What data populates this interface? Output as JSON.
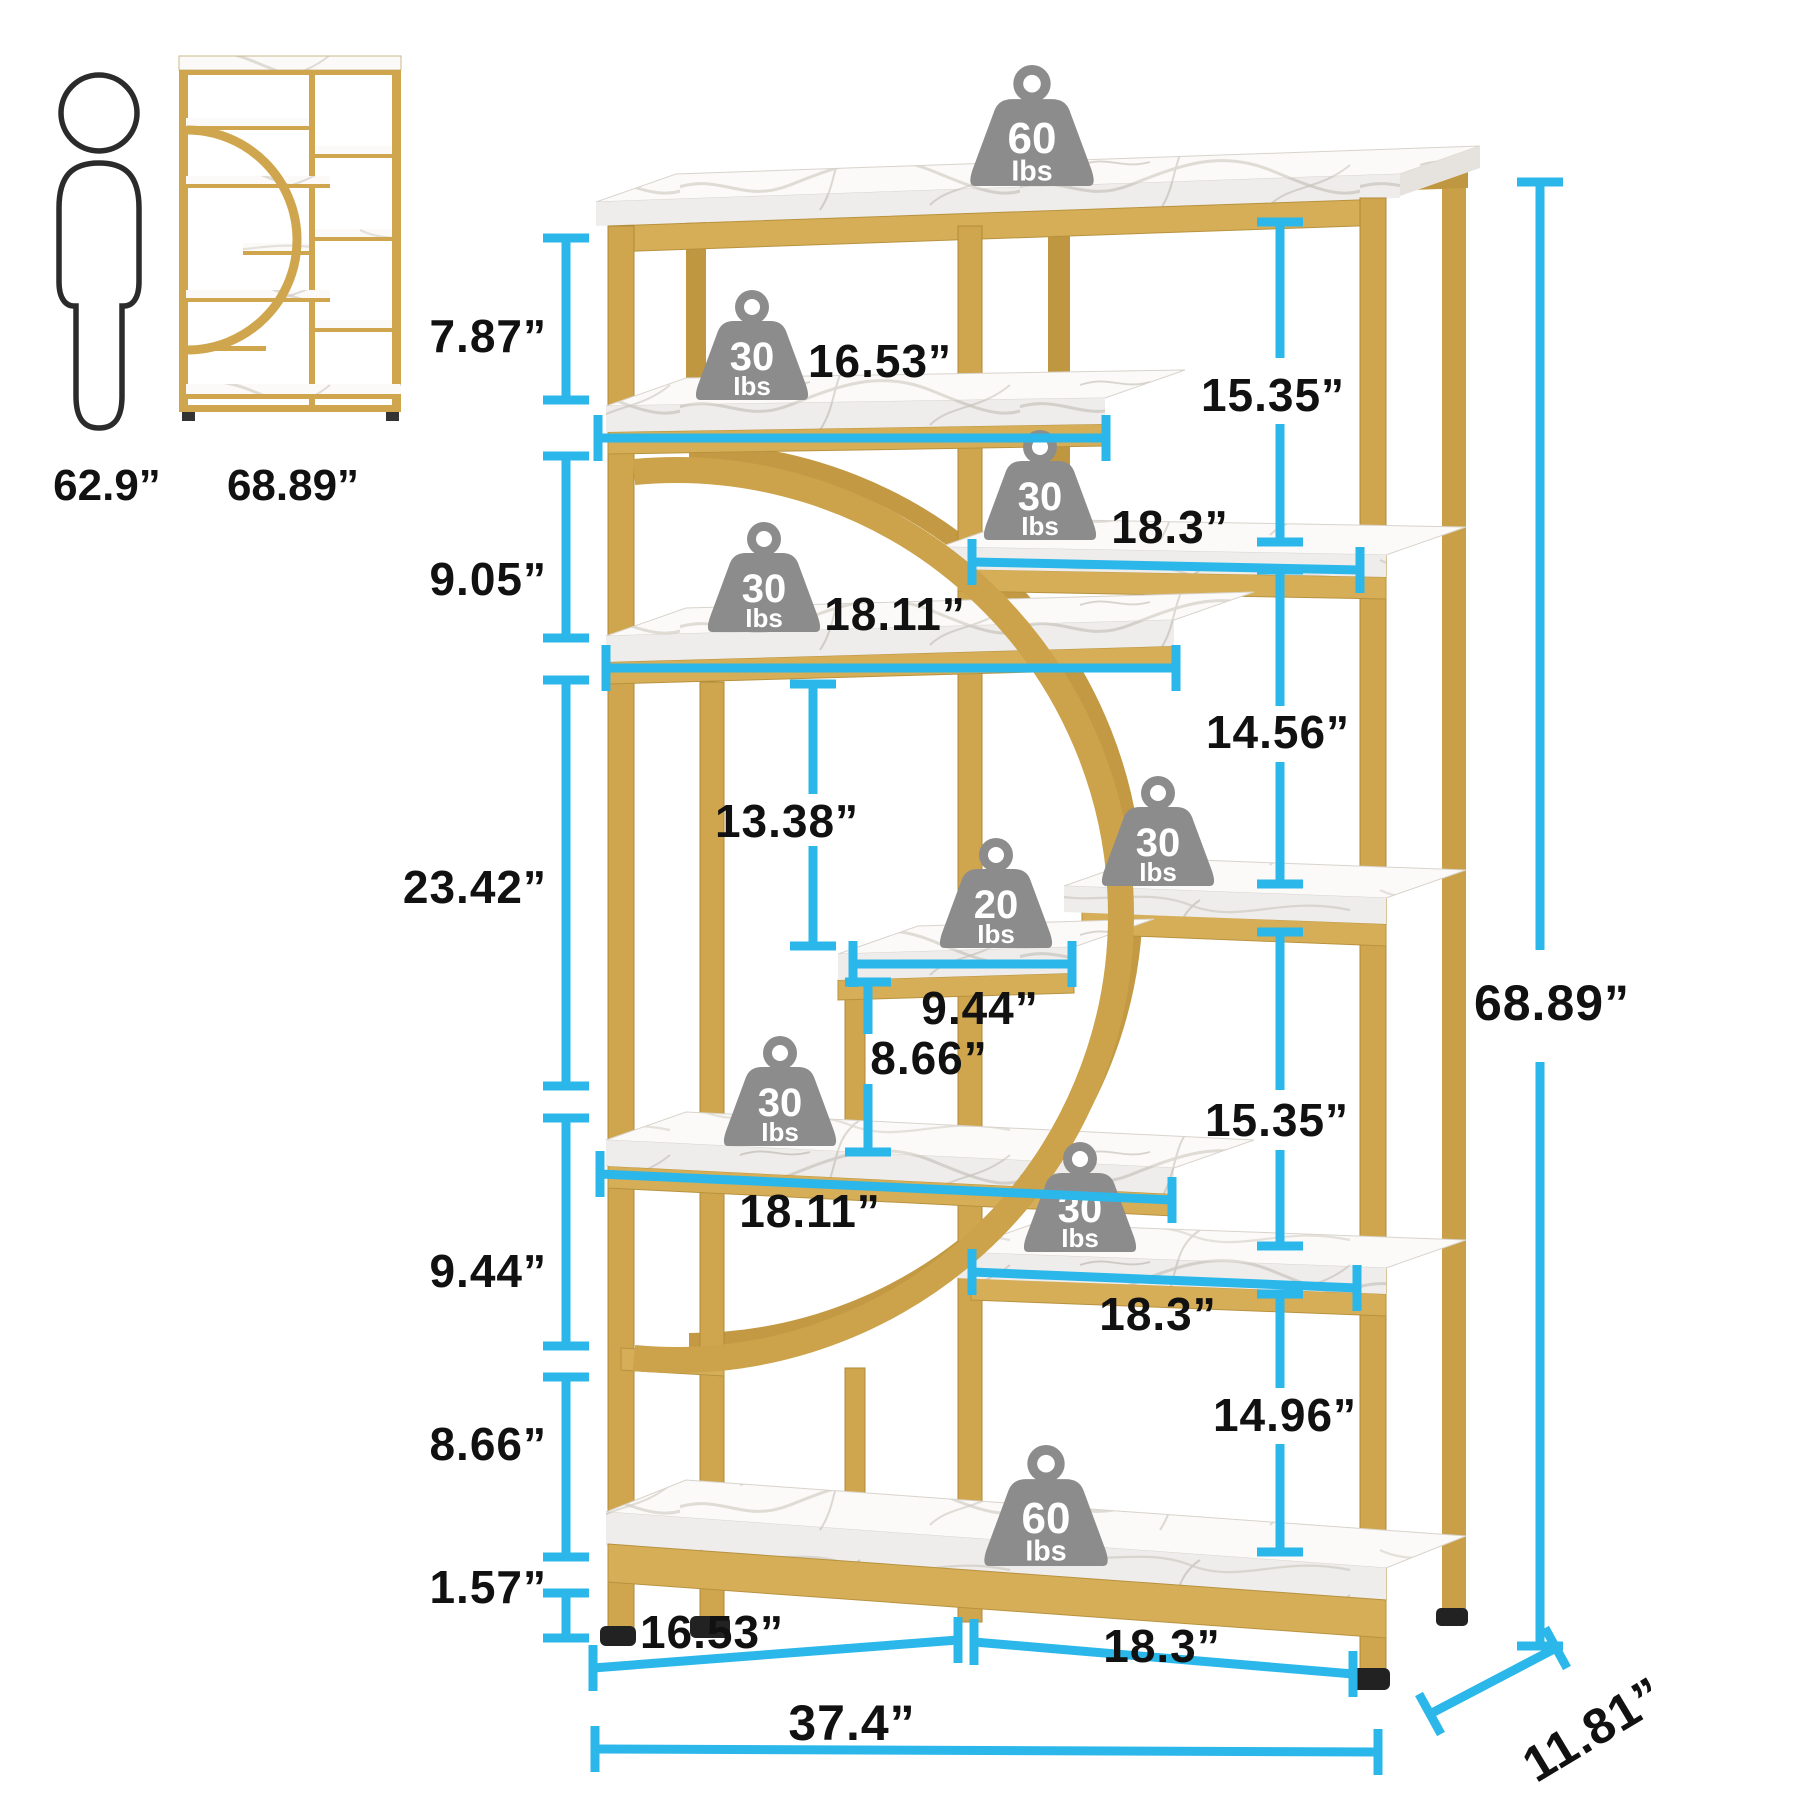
{
  "title": "Etagere bookshelf dimension diagram",
  "colors": {
    "gold": "#CFA64E",
    "gold_light": "#D9B262",
    "gold_dark": "#C09741",
    "marble": "#FAF9F7",
    "dimension_accent": "#2BB7E9",
    "weight_gray": "#8C8C8C",
    "label_black": "#111111"
  },
  "scale_reference": {
    "person_height": "62.9”",
    "unit_height": "68.89”"
  },
  "weights": {
    "unit_label": "Ibs",
    "top_shelf": "60",
    "shelf_a": "30",
    "right_shelf_1": "30",
    "shelf_b": "30",
    "middle_shelf": "20",
    "right_shelf_2": "30",
    "shelf_c": "30",
    "right_shelf_3": "30",
    "bottom_shelf": "60"
  },
  "dimensions": {
    "left": {
      "top_to_shelf_a": "7.87”",
      "shelf_a_to_shelf_b": "9.05”",
      "shelf_b_to_shelf_c": "23.42”",
      "shelf_c_to_rail": "9.44”",
      "rail_to_bottom_shelf": "8.66”",
      "foot_height": "1.57”"
    },
    "middle": {
      "shelf_a_width": "16.53”",
      "shelf_b_width": "18.11”",
      "shelf_b_to_middle_shelf": "13.38”",
      "middle_shelf_width": "9.44”",
      "middle_shelf_to_shelf_c": "8.66”",
      "shelf_c_width": "18.11”"
    },
    "right": {
      "top_to_shelf_1": "15.35”",
      "shelf_1_width": "18.3”",
      "shelf_1_to_shelf_2": "14.56”",
      "shelf_2_to_shelf_3": "15.35”",
      "shelf_3_width": "18.3”",
      "shelf_3_to_bottom": "14.96”",
      "bottom_right_width": "18.3”"
    },
    "overall": {
      "height": "68.89”",
      "width": "37.4”",
      "depth": "11.81”",
      "bottom_left_width": "16.53”"
    }
  }
}
